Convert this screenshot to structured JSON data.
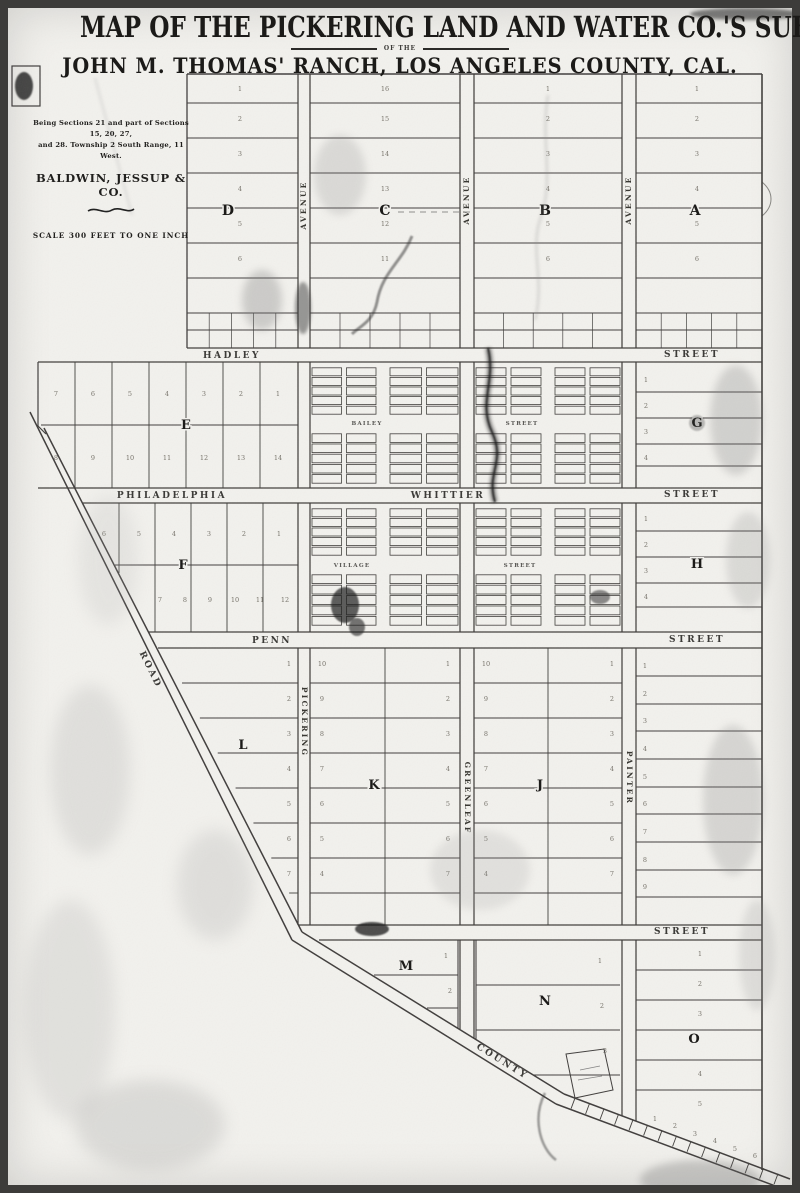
{
  "title": {
    "line1": "MAP OF THE PICKERING LAND AND WATER CO.'S SUBDIVISION",
    "connector": "OF THE",
    "line2": "JOHN M. THOMAS' RANCH, LOS ANGELES COUNTY, CAL."
  },
  "legend": {
    "description_line1": "Being Sections 21 and part of Sections 15, 20, 27,",
    "description_line2": "and 28.  Township 2 South Range, 11 West.",
    "firm": "BALDWIN, JESSUP & CO.",
    "scale_note": "SCALE 300 FEET TO ONE INCH"
  },
  "streets": {
    "hadley": "HADLEY",
    "philadelphia": "PHILADELPHIA",
    "whittier": "WHITTIER",
    "penn": "PENN",
    "bailey": "BAILEY",
    "village": "VILLAGE",
    "street": "STREET",
    "avenue": "AVENUE",
    "pickering": "PICKERING",
    "greenleaf": "GREENLEAF",
    "painter": "PAINTER",
    "road": "ROAD",
    "county": "COUNTY"
  },
  "blocks": {
    "A": "A",
    "B": "B",
    "C": "C",
    "D": "D",
    "E": "E",
    "F": "F",
    "G": "G",
    "H": "H",
    "J": "J",
    "K": "K",
    "L": "L",
    "M": "M",
    "N": "N",
    "O": "O"
  },
  "lots": {
    "top_D": [
      "1",
      "2",
      "3",
      "4",
      "5",
      "6"
    ],
    "top_C": [
      "16",
      "15",
      "14",
      "13",
      "12",
      "11"
    ],
    "top_B": [
      "1",
      "2",
      "3",
      "4",
      "5",
      "6"
    ],
    "top_A": [
      "1",
      "2",
      "3",
      "4",
      "5",
      "6"
    ],
    "E_top": [
      "7",
      "6",
      "5",
      "4",
      "3",
      "2",
      "1"
    ],
    "E_bottom": [
      "8",
      "9",
      "10",
      "11",
      "12",
      "13",
      "14"
    ],
    "F_top": [
      "6",
      "5",
      "4",
      "3",
      "2",
      "1"
    ],
    "F_bottom": [
      "7",
      "8",
      "9",
      "10",
      "11",
      "12"
    ],
    "G": [
      "1",
      "2",
      "3",
      "4"
    ],
    "H": [
      "1",
      "2",
      "3",
      "4"
    ],
    "K_left": [
      "10",
      "9",
      "8",
      "7",
      "6",
      "5",
      "4"
    ],
    "K_right": [
      "1",
      "2",
      "3",
      "4",
      "5",
      "6",
      "7"
    ],
    "J_left": [
      "10",
      "9",
      "8",
      "7",
      "6",
      "5",
      "4"
    ],
    "J_right": [
      "1",
      "2",
      "3",
      "4",
      "5",
      "6",
      "7"
    ],
    "L": [
      "1",
      "2",
      "3",
      "4",
      "5",
      "6",
      "7"
    ],
    "right_strip": [
      "1",
      "2",
      "3",
      "4",
      "5",
      "6",
      "7",
      "8",
      "9"
    ],
    "M": [
      "1",
      "2"
    ],
    "N": [
      "1",
      "2",
      "3"
    ],
    "O": [
      "1",
      "2",
      "3",
      "4",
      "5"
    ],
    "bottom_strip": [
      "1",
      "2",
      "3",
      "4",
      "5",
      "6"
    ]
  }
}
